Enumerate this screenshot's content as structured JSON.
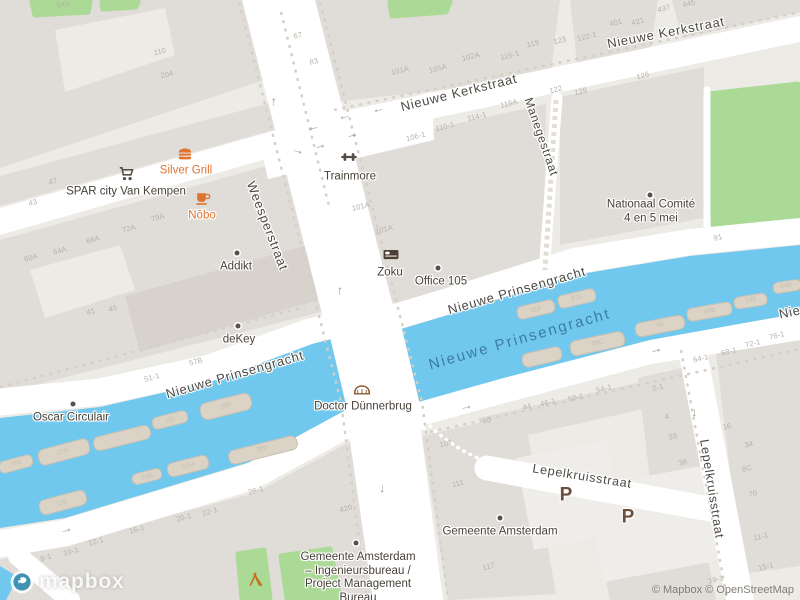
{
  "attribution": {
    "logo": "mapbox",
    "text": "© Mapbox © OpenStreetMap"
  },
  "colors": {
    "land": "#edebe6",
    "building": "#e0dcd7",
    "building2": "#d7d2cc",
    "lot": "#efede9",
    "road": "#ffffff",
    "water": "#70c8ee",
    "green": "#abda96",
    "dash": "#d4cfc4",
    "street": "#4d4a44",
    "watertext": "#3c7ca3",
    "poidark": "#474239",
    "orange": "#dd7530",
    "num": "#b6b1a8",
    "parking": "#6a4e3e"
  },
  "arrow_glyph": "→",
  "street_labels": [
    {
      "id": "nieuwe-kerkstraat-west",
      "text": "Nieuwe Kerkstraat",
      "x": 459,
      "y": 93,
      "rot": -14,
      "size": 13
    },
    {
      "id": "nieuwe-kerkstraat-east",
      "text": "Nieuwe Kerkstraat",
      "x": 666,
      "y": 33,
      "rot": -11,
      "size": 13
    },
    {
      "id": "weesperstraat",
      "text": "Weesperstraat",
      "x": 267,
      "y": 226,
      "rot": 69,
      "size": 13
    },
    {
      "id": "manegestraat",
      "text": "Manegestraat",
      "x": 541,
      "y": 137,
      "rot": 71,
      "size": 12
    },
    {
      "id": "nieuwe-prinsengracht-west",
      "text": "Nieuwe Prinsengracht",
      "x": 235,
      "y": 375,
      "rot": -16,
      "size": 13
    },
    {
      "id": "nieuwe-prinsengracht-east",
      "text": "Nieuwe Prinsengracht",
      "x": 517,
      "y": 291,
      "rot": -16,
      "size": 13
    },
    {
      "id": "nieuwe-prinsengracht-edge",
      "text": "Nieuwe Prinsengracht",
      "x": 849,
      "y": 300,
      "rot": -12,
      "size": 13
    },
    {
      "id": "lepelkruisstraat-h",
      "text": "Lepelkruisstraat",
      "x": 582,
      "y": 477,
      "rot": 9,
      "size": 12.5
    },
    {
      "id": "lepelkruisstraat-v",
      "text": "Lepelkruisstraat",
      "x": 711,
      "y": 489,
      "rot": 81,
      "size": 12.5
    }
  ],
  "water_labels": [
    {
      "id": "nieuwe-prinsengracht-water",
      "text": "Nieuwe Prinsengracht",
      "x": 520,
      "y": 340,
      "rot": -16
    }
  ],
  "pois": [
    {
      "id": "spar-city-van-kempen",
      "label": "SPAR city Van Kempen",
      "x": 126,
      "y": 192,
      "icon": "cart",
      "icon_class": "dark",
      "icon_x": 127,
      "icon_y": 174,
      "color": "dark"
    },
    {
      "id": "silver-grill",
      "label": "Silver Grill",
      "x": 186,
      "y": 171,
      "icon": "burger",
      "icon_class": "orange",
      "icon_x": 185,
      "icon_y": 154,
      "color": "orange"
    },
    {
      "id": "nobo",
      "label": "Nōbo",
      "x": 202,
      "y": 216,
      "icon": "cup",
      "icon_class": "orange",
      "icon_x": 203,
      "icon_y": 198,
      "color": "orange"
    },
    {
      "id": "addikt",
      "label": "Addikt",
      "x": 236,
      "y": 267,
      "dot": true,
      "dot_x": 237,
      "dot_y": 253,
      "color": "dark"
    },
    {
      "id": "trainmore",
      "label": "Trainmore",
      "x": 350,
      "y": 177,
      "icon": "dumbbell",
      "icon_class": "dark",
      "icon_x": 349,
      "icon_y": 157,
      "color": "dark"
    },
    {
      "id": "zoku",
      "label": "Zoku",
      "x": 390,
      "y": 273,
      "icon": "bed",
      "icon_class": "bed",
      "icon_x": 391,
      "icon_y": 254,
      "color": "dark"
    },
    {
      "id": "office-105",
      "label": "Office 105",
      "x": 441,
      "y": 282,
      "dot": true,
      "dot_x": 438,
      "dot_y": 268,
      "color": "dark"
    },
    {
      "id": "nationaal-comite-4-en-5-mei",
      "lines": [
        "Nationaal Comité",
        "4 en 5 mei"
      ],
      "x": 651,
      "y": 212,
      "dot": true,
      "dot_x": 650,
      "dot_y": 195,
      "color": "dark"
    },
    {
      "id": "dekey",
      "label": "deKey",
      "x": 239,
      "y": 340,
      "dot": true,
      "dot_x": 238,
      "dot_y": 326,
      "color": "dark"
    },
    {
      "id": "oscar-circulair",
      "label": "Oscar Circulair",
      "x": 71,
      "y": 418,
      "dot": true,
      "dot_x": 73,
      "dot_y": 404,
      "color": "dark"
    },
    {
      "id": "doctor-dunnerbrug",
      "label": "Doctor Dünnerbrug",
      "x": 363,
      "y": 407,
      "icon": "bridge",
      "icon_class": "bridge",
      "icon_x": 362,
      "icon_y": 389,
      "color": "dark"
    },
    {
      "id": "gemeente-amsterdam",
      "label": "Gemeente Amsterdam",
      "x": 500,
      "y": 532,
      "dot": true,
      "dot_x": 500,
      "dot_y": 518,
      "color": "dark"
    },
    {
      "id": "gemeente-amsterdam-ingenieursbureau",
      "lines": [
        "Gemeente Amsterdam",
        "– Ingenieursbureau /",
        "Project Management",
        "Bureau"
      ],
      "x": 358,
      "y": 578,
      "dot": true,
      "dot_x": 356,
      "dot_y": 543,
      "color": "dark"
    },
    {
      "id": "playground",
      "label": "",
      "x": 256,
      "y": 596,
      "icon": "playground",
      "icon_class": "play",
      "icon_x": 256,
      "icon_y": 580,
      "color": "dark"
    }
  ],
  "parking": [
    {
      "label": "P",
      "x": 566,
      "y": 496
    },
    {
      "label": "P",
      "x": 628,
      "y": 518
    }
  ],
  "house_numbers": [
    {
      "x": 63,
      "y": 5,
      "t": "649",
      "r": -10
    },
    {
      "x": 160,
      "y": 52,
      "t": "110",
      "r": -14
    },
    {
      "x": 167,
      "y": 75,
      "t": "204",
      "r": -14
    },
    {
      "x": 298,
      "y": 36,
      "t": "67",
      "r": -15
    },
    {
      "x": 314,
      "y": 62,
      "t": "83",
      "r": -15
    },
    {
      "x": 53,
      "y": 182,
      "t": "47",
      "r": -15
    },
    {
      "x": 33,
      "y": 203,
      "t": "43",
      "r": -15
    },
    {
      "x": 31,
      "y": 258,
      "t": "60A",
      "r": -15
    },
    {
      "x": 60,
      "y": 251,
      "t": "64A",
      "r": -15
    },
    {
      "x": 93,
      "y": 240,
      "t": "66A",
      "r": -15
    },
    {
      "x": 129,
      "y": 229,
      "t": "72A",
      "r": -15
    },
    {
      "x": 158,
      "y": 218,
      "t": "79A",
      "r": -15
    },
    {
      "x": 361,
      "y": 207,
      "t": "101A",
      "r": -14
    },
    {
      "x": 384,
      "y": 230,
      "t": "101A",
      "r": -14
    },
    {
      "x": 400,
      "y": 71,
      "t": "101A",
      "r": -14
    },
    {
      "x": 438,
      "y": 69,
      "t": "105A",
      "r": -14
    },
    {
      "x": 471,
      "y": 57,
      "t": "102A",
      "r": -14
    },
    {
      "x": 510,
      "y": 56,
      "t": "115-1",
      "r": -14
    },
    {
      "x": 533,
      "y": 44,
      "t": "119",
      "r": -14
    },
    {
      "x": 560,
      "y": 41,
      "t": "123",
      "r": -14
    },
    {
      "x": 587,
      "y": 37,
      "t": "122-1",
      "r": -14
    },
    {
      "x": 616,
      "y": 23,
      "t": "401",
      "r": -14
    },
    {
      "x": 638,
      "y": 22,
      "t": "421",
      "r": -14
    },
    {
      "x": 664,
      "y": 9,
      "t": "437",
      "r": -14
    },
    {
      "x": 689,
      "y": 4,
      "t": "445",
      "r": -14
    },
    {
      "x": 416,
      "y": 137,
      "t": "106-1",
      "r": -14
    },
    {
      "x": 445,
      "y": 127,
      "t": "110-1",
      "r": -14
    },
    {
      "x": 477,
      "y": 117,
      "t": "114-1",
      "r": -14
    },
    {
      "x": 509,
      "y": 104,
      "t": "118A",
      "r": -14
    },
    {
      "x": 556,
      "y": 90,
      "t": "122",
      "r": -14
    },
    {
      "x": 581,
      "y": 92,
      "t": "128",
      "r": -14
    },
    {
      "x": 643,
      "y": 76,
      "t": "126",
      "r": -14
    },
    {
      "x": 718,
      "y": 238,
      "t": "91",
      "r": -14
    },
    {
      "x": 91,
      "y": 312,
      "t": "41",
      "r": -15
    },
    {
      "x": 113,
      "y": 309,
      "t": "45",
      "r": -15
    },
    {
      "x": 152,
      "y": 378,
      "t": "51-1",
      "r": -15
    },
    {
      "x": 196,
      "y": 362,
      "t": "57B",
      "r": -15
    },
    {
      "x": 46,
      "y": 558,
      "t": "8-1",
      "r": -15
    },
    {
      "x": 71,
      "y": 552,
      "t": "10-1",
      "r": -15
    },
    {
      "x": 96,
      "y": 542,
      "t": "12-1",
      "r": -15
    },
    {
      "x": 137,
      "y": 530,
      "t": "16-1",
      "r": -15
    },
    {
      "x": 184,
      "y": 518,
      "t": "20-1",
      "r": -15
    },
    {
      "x": 210,
      "y": 512,
      "t": "22-1",
      "r": -15
    },
    {
      "x": 256,
      "y": 491,
      "t": "26-1",
      "r": -15
    },
    {
      "x": 346,
      "y": 509,
      "t": "420",
      "r": -14
    },
    {
      "x": 446,
      "y": 444,
      "t": "107",
      "r": -14
    },
    {
      "x": 458,
      "y": 484,
      "t": "111",
      "r": -14
    },
    {
      "x": 489,
      "y": 567,
      "t": "117",
      "r": -14
    },
    {
      "x": 487,
      "y": 421,
      "t": "40",
      "r": -14
    },
    {
      "x": 527,
      "y": 407,
      "t": "44",
      "r": -14
    },
    {
      "x": 548,
      "y": 403,
      "t": "46-1",
      "r": -14
    },
    {
      "x": 576,
      "y": 398,
      "t": "50-1",
      "r": -14
    },
    {
      "x": 604,
      "y": 389,
      "t": "54-1",
      "r": -14
    },
    {
      "x": 658,
      "y": 388,
      "t": "2-1",
      "r": -14
    },
    {
      "x": 667,
      "y": 417,
      "t": "4",
      "r": -14
    },
    {
      "x": 673,
      "y": 437,
      "t": "28",
      "r": -14
    },
    {
      "x": 683,
      "y": 463,
      "t": "38",
      "r": -14
    },
    {
      "x": 701,
      "y": 359,
      "t": "64-1",
      "r": -13
    },
    {
      "x": 729,
      "y": 352,
      "t": "68-1",
      "r": -13
    },
    {
      "x": 753,
      "y": 344,
      "t": "72-1",
      "r": -13
    },
    {
      "x": 777,
      "y": 336,
      "t": "76-1",
      "r": -13
    },
    {
      "x": 727,
      "y": 427,
      "t": "16",
      "r": -13
    },
    {
      "x": 749,
      "y": 445,
      "t": "34",
      "r": -13
    },
    {
      "x": 747,
      "y": 469,
      "t": "8C",
      "r": -13
    },
    {
      "x": 753,
      "y": 494,
      "t": "70",
      "r": -13
    },
    {
      "x": 761,
      "y": 537,
      "t": "11-1",
      "r": -13
    },
    {
      "x": 766,
      "y": 567,
      "t": "15-1",
      "r": -13
    },
    {
      "x": 716,
      "y": 580,
      "t": "19-1",
      "r": -13
    }
  ],
  "boat_numbers": [
    {
      "x": 16,
      "y": 464,
      "t": "77K",
      "r": -15
    },
    {
      "x": 63,
      "y": 452,
      "t": "37H",
      "r": -15
    },
    {
      "x": 170,
      "y": 420,
      "t": "110",
      "r": -14
    },
    {
      "x": 226,
      "y": 406,
      "t": "25F",
      "r": -14
    },
    {
      "x": 262,
      "y": 449,
      "t": "30B",
      "r": -14
    },
    {
      "x": 188,
      "y": 466,
      "t": "22H",
      "r": -14
    },
    {
      "x": 147,
      "y": 477,
      "t": "14B",
      "r": -14
    },
    {
      "x": 62,
      "y": 503,
      "t": "120",
      "r": -15
    },
    {
      "x": 536,
      "y": 310,
      "t": "91F",
      "r": -13
    },
    {
      "x": 577,
      "y": 298,
      "t": "87K",
      "r": -13
    },
    {
      "x": 598,
      "y": 343,
      "t": "58C",
      "r": -12
    },
    {
      "x": 660,
      "y": 325,
      "t": "40",
      "r": -11
    },
    {
      "x": 710,
      "y": 311,
      "t": "48B",
      "r": -10
    },
    {
      "x": 751,
      "y": 300,
      "t": "24B",
      "r": -9
    },
    {
      "x": 786,
      "y": 286,
      "t": "84B",
      "r": -9
    }
  ],
  "road_arrows": [
    {
      "x": 272,
      "y": 102,
      "r": -90
    },
    {
      "x": 338,
      "y": 291,
      "r": -83
    },
    {
      "x": 384,
      "y": 489,
      "r": 97
    },
    {
      "x": 696,
      "y": 413,
      "r": 96
    },
    {
      "x": 379,
      "y": 112,
      "r": 168
    },
    {
      "x": 345,
      "y": 119,
      "r": 168
    },
    {
      "x": 314,
      "y": 130,
      "r": 168
    },
    {
      "x": 320,
      "y": 145,
      "r": -13
    },
    {
      "x": 352,
      "y": 134,
      "r": -13
    },
    {
      "x": 298,
      "y": 150,
      "r": 15
    },
    {
      "x": 66,
      "y": 529,
      "r": -15
    },
    {
      "x": 466,
      "y": 406,
      "r": -14
    },
    {
      "x": 656,
      "y": 349,
      "r": -13
    }
  ]
}
